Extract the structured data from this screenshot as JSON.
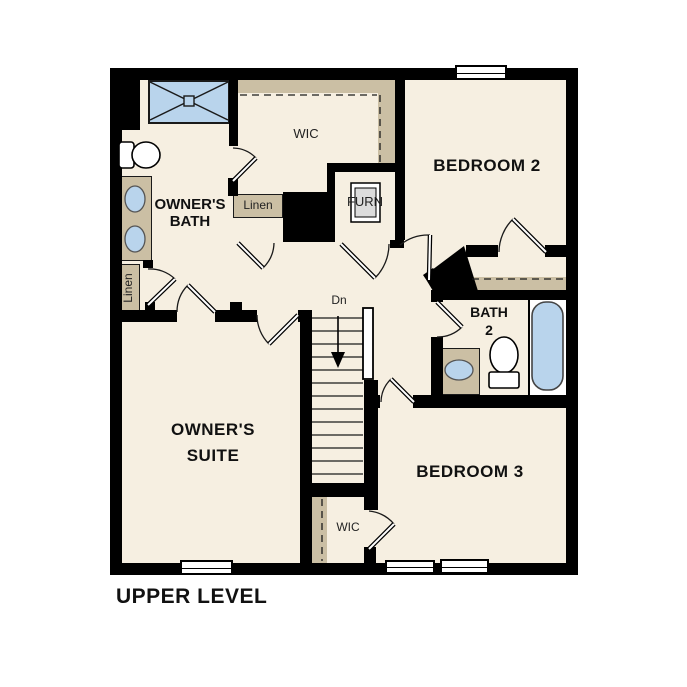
{
  "title": "UPPER LEVEL",
  "labels": {
    "owners_bath_1": "OWNER'S",
    "owners_bath_2": "BATH",
    "owners_suite_1": "OWNER'S",
    "owners_suite_2": "SUITE",
    "bedroom2": "BEDROOM 2",
    "bedroom3": "BEDROOM 3",
    "bath2_1": "BATH",
    "bath2_2": "2",
    "wic_top": "WIC",
    "wic_bottom": "WIC",
    "linen_left": "Linen",
    "linen_top": "Linen",
    "furnace": "FURN",
    "stairs_down": "Dn"
  },
  "colors": {
    "floor": "#f6efe1",
    "wall": "#000000",
    "shelf_tan": "#cbbfa4",
    "fixture_blue": "#b9d4ec",
    "furnace_gray": "#dcdcdc",
    "background": "#ffffff"
  }
}
